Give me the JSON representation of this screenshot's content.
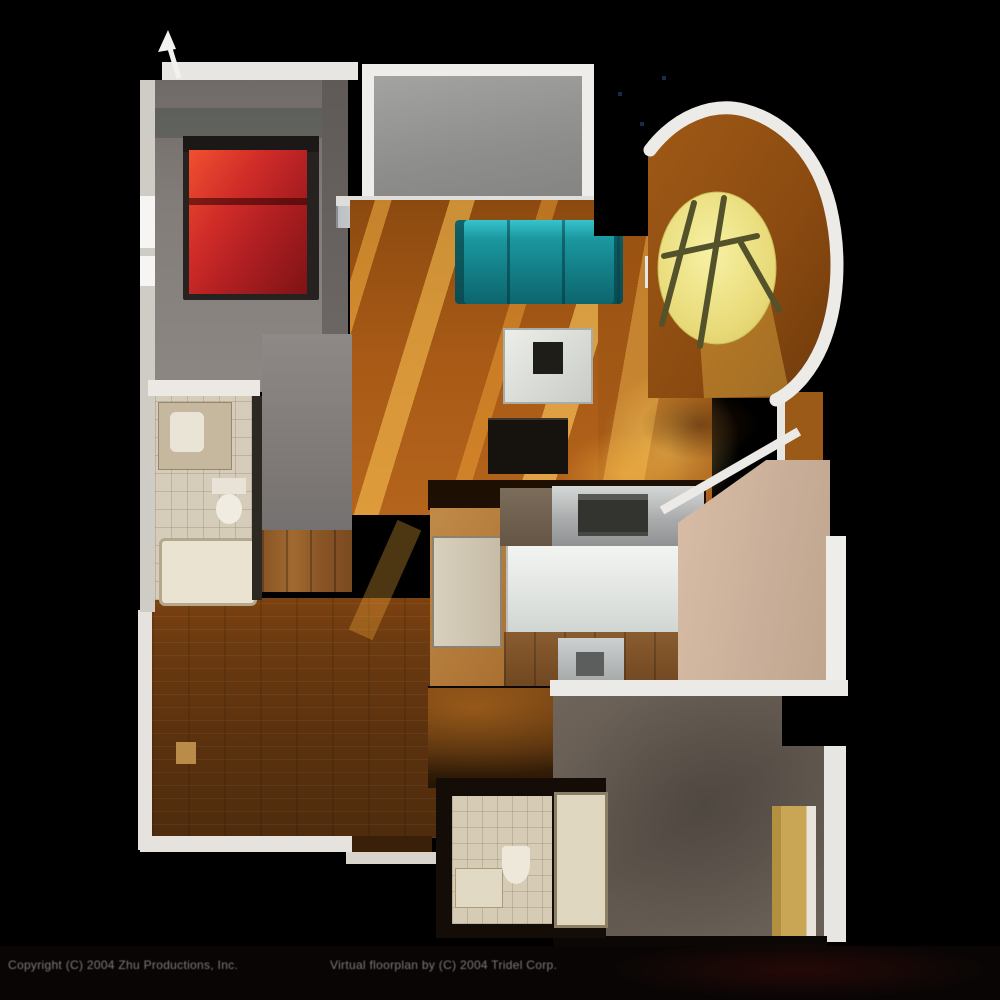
{
  "scene": {
    "type": "3d-floorplan-render",
    "background": "#000000"
  },
  "footer": {
    "left_credit": "Copyright (C) 2004 Zhu Productions, Inc.",
    "right_credit": "Virtual floorplan by (C) 2004 Tridel Corp."
  },
  "palette": {
    "background": "#000000",
    "wall_white": "#eceae6",
    "wood_living": "#a85a16",
    "wood_dark": "#5f330e",
    "sunlight_streak": "#ffcf5e",
    "bedroom_carpet": "#837d7a",
    "bed_red": "#c1272d",
    "sofa_teal": "#17858d",
    "round_table_yellow": "#e8da78",
    "tile_beige": "#d5ccba",
    "island_white": "#eef0ee",
    "stainless": "#a9abac",
    "door_tan": "#c9a656",
    "hall_floor_pink": "#d9bda6",
    "bedroom2_floor": "#6a6158",
    "balcony_gray": "#8e8e8c"
  },
  "regions": [
    {
      "id": "master-bedroom",
      "floor_color": "#837d7a"
    },
    {
      "id": "balcony",
      "floor_color": "#8e8e8c"
    },
    {
      "id": "living-room",
      "floor_color": "#a85a16"
    },
    {
      "id": "bay-window-dining",
      "floor_color": "#a05a16"
    },
    {
      "id": "bathroom-1",
      "floor_color": "#d5ccba"
    },
    {
      "id": "hallway-closet",
      "floor_color": "#7d7875"
    },
    {
      "id": "kitchen",
      "floor_color": "#b57b3a"
    },
    {
      "id": "den-dining",
      "floor_color": "#5f330e"
    },
    {
      "id": "hall-foyer",
      "floor_color": "#d9bda6"
    },
    {
      "id": "bedroom-2",
      "floor_color": "#6a6158"
    },
    {
      "id": "bathroom-2",
      "floor_color": "#d6cbb5"
    }
  ],
  "furniture": [
    "double-bed",
    "teal-sofa",
    "coffee-table",
    "tv-console",
    "round-sunlit-table",
    "side-table",
    "vanity-sink",
    "toilet",
    "bathtub",
    "refrigerator",
    "range-oven",
    "kitchen-island",
    "sink-counter",
    "tan-door-left",
    "tan-door-right",
    "shower-tub",
    "entry-arrow"
  ]
}
